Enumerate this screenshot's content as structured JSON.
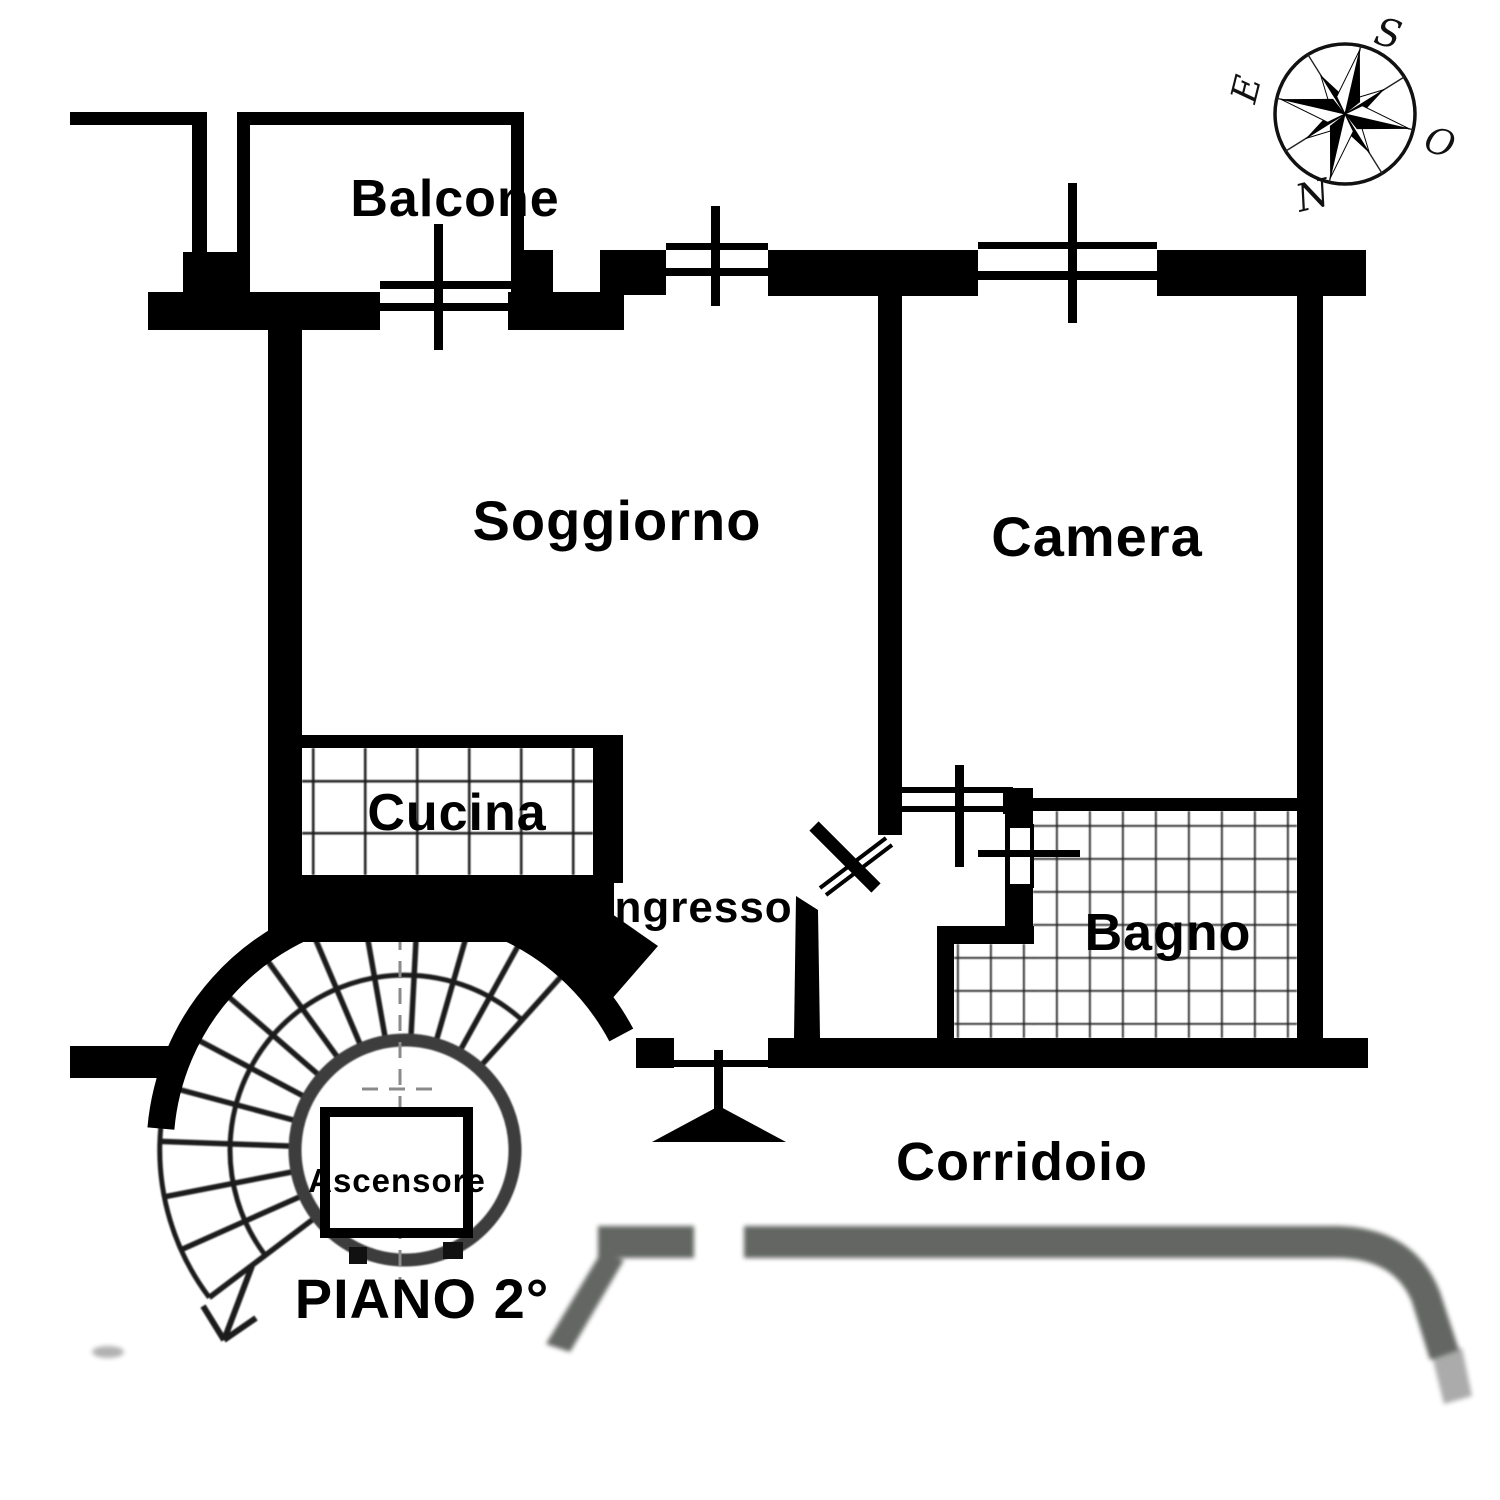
{
  "floor_plan": {
    "floor_label": "PIANO 2°",
    "rooms": {
      "balcone": "Balcone",
      "soggiorno": "Soggiorno",
      "camera": "Camera",
      "cucina": "Cucina",
      "ingresso": "Ingresso",
      "bagno": "Bagno",
      "ascensore": "Ascensore",
      "corridoio": "Corridoio"
    },
    "compass": {
      "south": "S",
      "east": "E",
      "west": "O",
      "north": "N"
    },
    "colors": {
      "wall": "#000000",
      "corridor_gray": "#474c47",
      "tile_line": "#1b1b1b",
      "background": "#ffffff"
    }
  }
}
